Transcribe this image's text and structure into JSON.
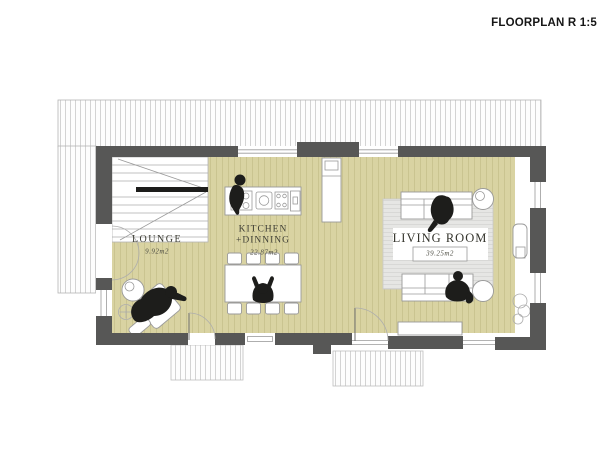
{
  "title": "FLOORPLAN R 1:5",
  "rooms": {
    "lounge": {
      "name": "LOUNGE",
      "area": "9.92m2"
    },
    "kitchen": {
      "name_line1": "KITCHEN",
      "name_line2": "+DINNING",
      "area": "22.87m2"
    },
    "living": {
      "name": "LIVING ROOM",
      "area": "39.25m2"
    }
  },
  "colors": {
    "wall": "#575756",
    "floor": "#d9d3a2",
    "floor_stripe": "#c7c08c",
    "rug": "#e6e6e4",
    "rug_stripe": "#d4d4d2",
    "hatch_line": "#c9c9c9",
    "silhouette": "#1d1d1b"
  }
}
